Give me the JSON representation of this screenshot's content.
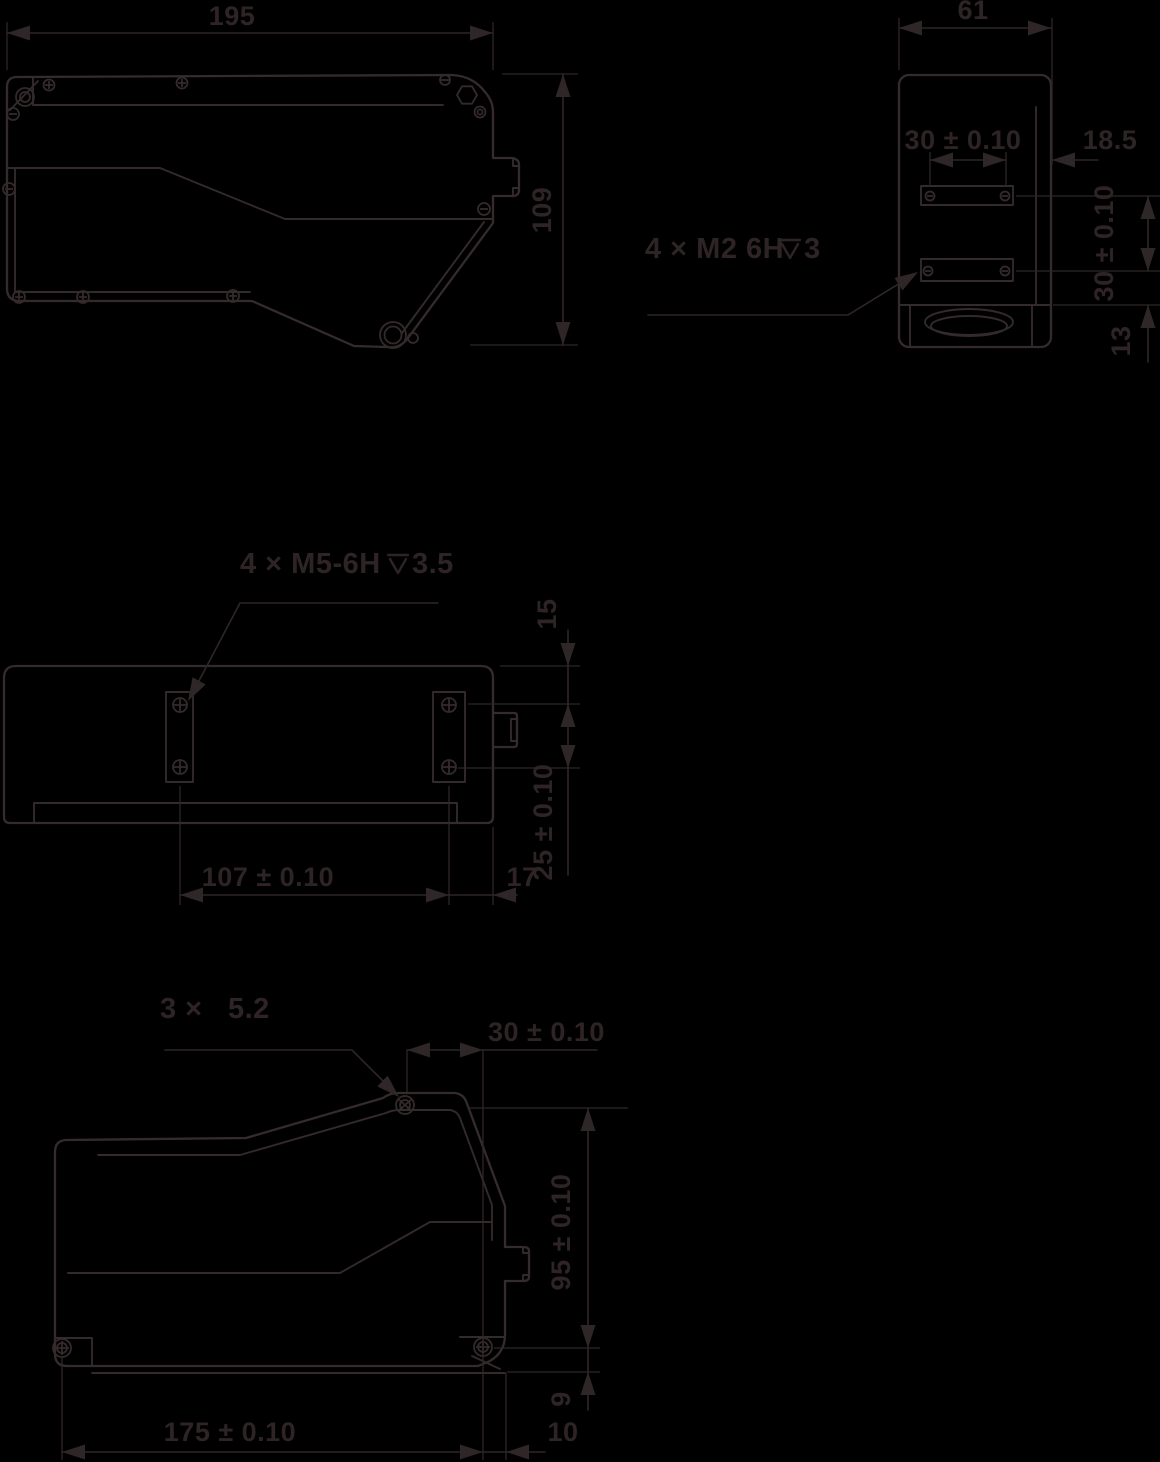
{
  "drawing": {
    "background_color": "#000000",
    "line_color": "#352b2c",
    "text_color": "#2e2425"
  },
  "views": {
    "side_top": {
      "width": "195",
      "height": "109"
    },
    "end": {
      "width": "61",
      "hole_spacing_h": "30 ± 0.10",
      "edge_offset": "18.5",
      "hole_spacing_v": "30 ± 0.10",
      "lens_offset": "13",
      "callout": {
        "prefix": "4 × M2 6H",
        "depth_symbol": "⊽",
        "depth_value": "3"
      }
    },
    "top": {
      "callout": {
        "prefix": "4 × M5-6H",
        "depth_symbol": "⊽",
        "depth_value": "3.5"
      },
      "top_offset": "15",
      "hole_offset": "25 ± 0.10",
      "hole_spacing": "107 ± 0.10",
      "edge_offset": "17"
    },
    "side_bottom": {
      "callout": {
        "prefix": "3 ×",
        "diameter_value": "5.2"
      },
      "top_spacing": "30 ± 0.10",
      "height": "95 ± 0.10",
      "base_offset": "9",
      "hole_spacing": "175 ± 0.10",
      "edge_offset": "10"
    }
  }
}
